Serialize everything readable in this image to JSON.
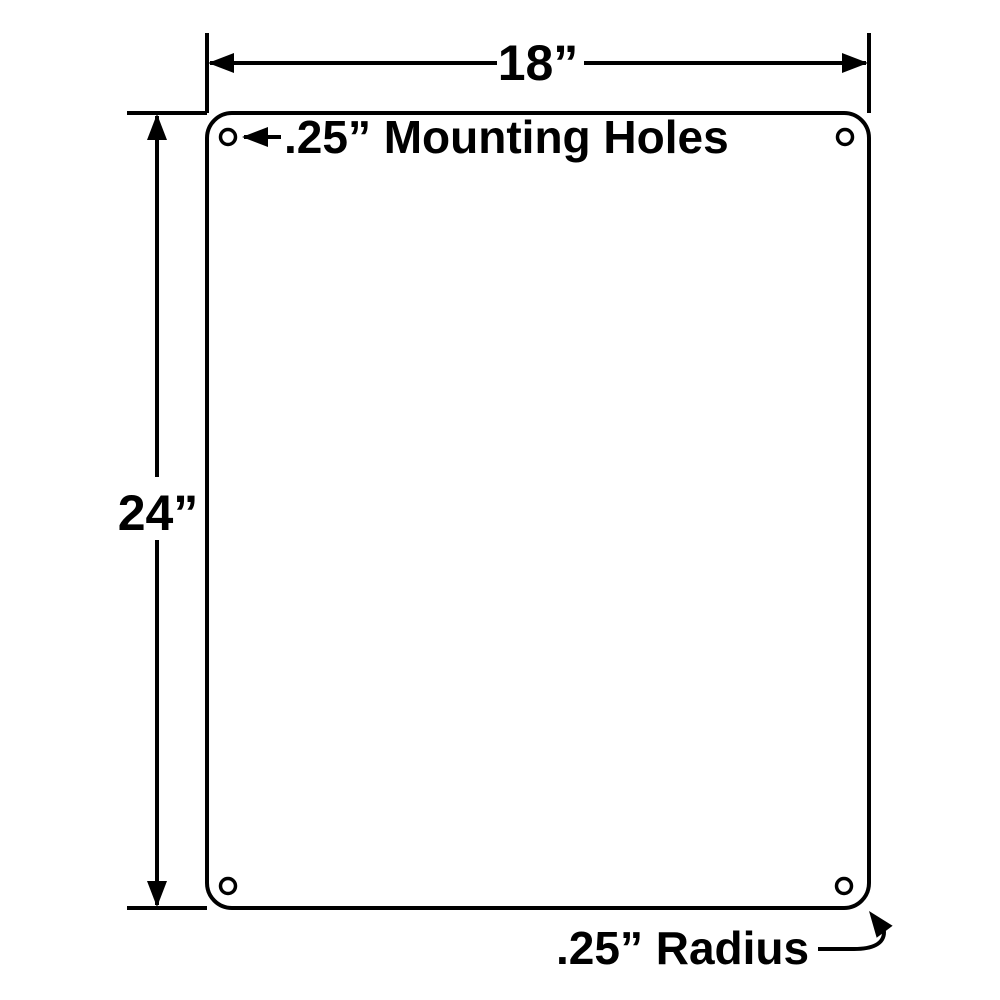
{
  "diagram": {
    "type": "sign-panel-dimension-drawing",
    "labels": {
      "width": "18”",
      "height": "24”",
      "mounting_holes": ".25” Mounting Holes",
      "radius": ".25” Radius"
    },
    "colors": {
      "line": "#000000",
      "background": "#ffffff"
    }
  }
}
